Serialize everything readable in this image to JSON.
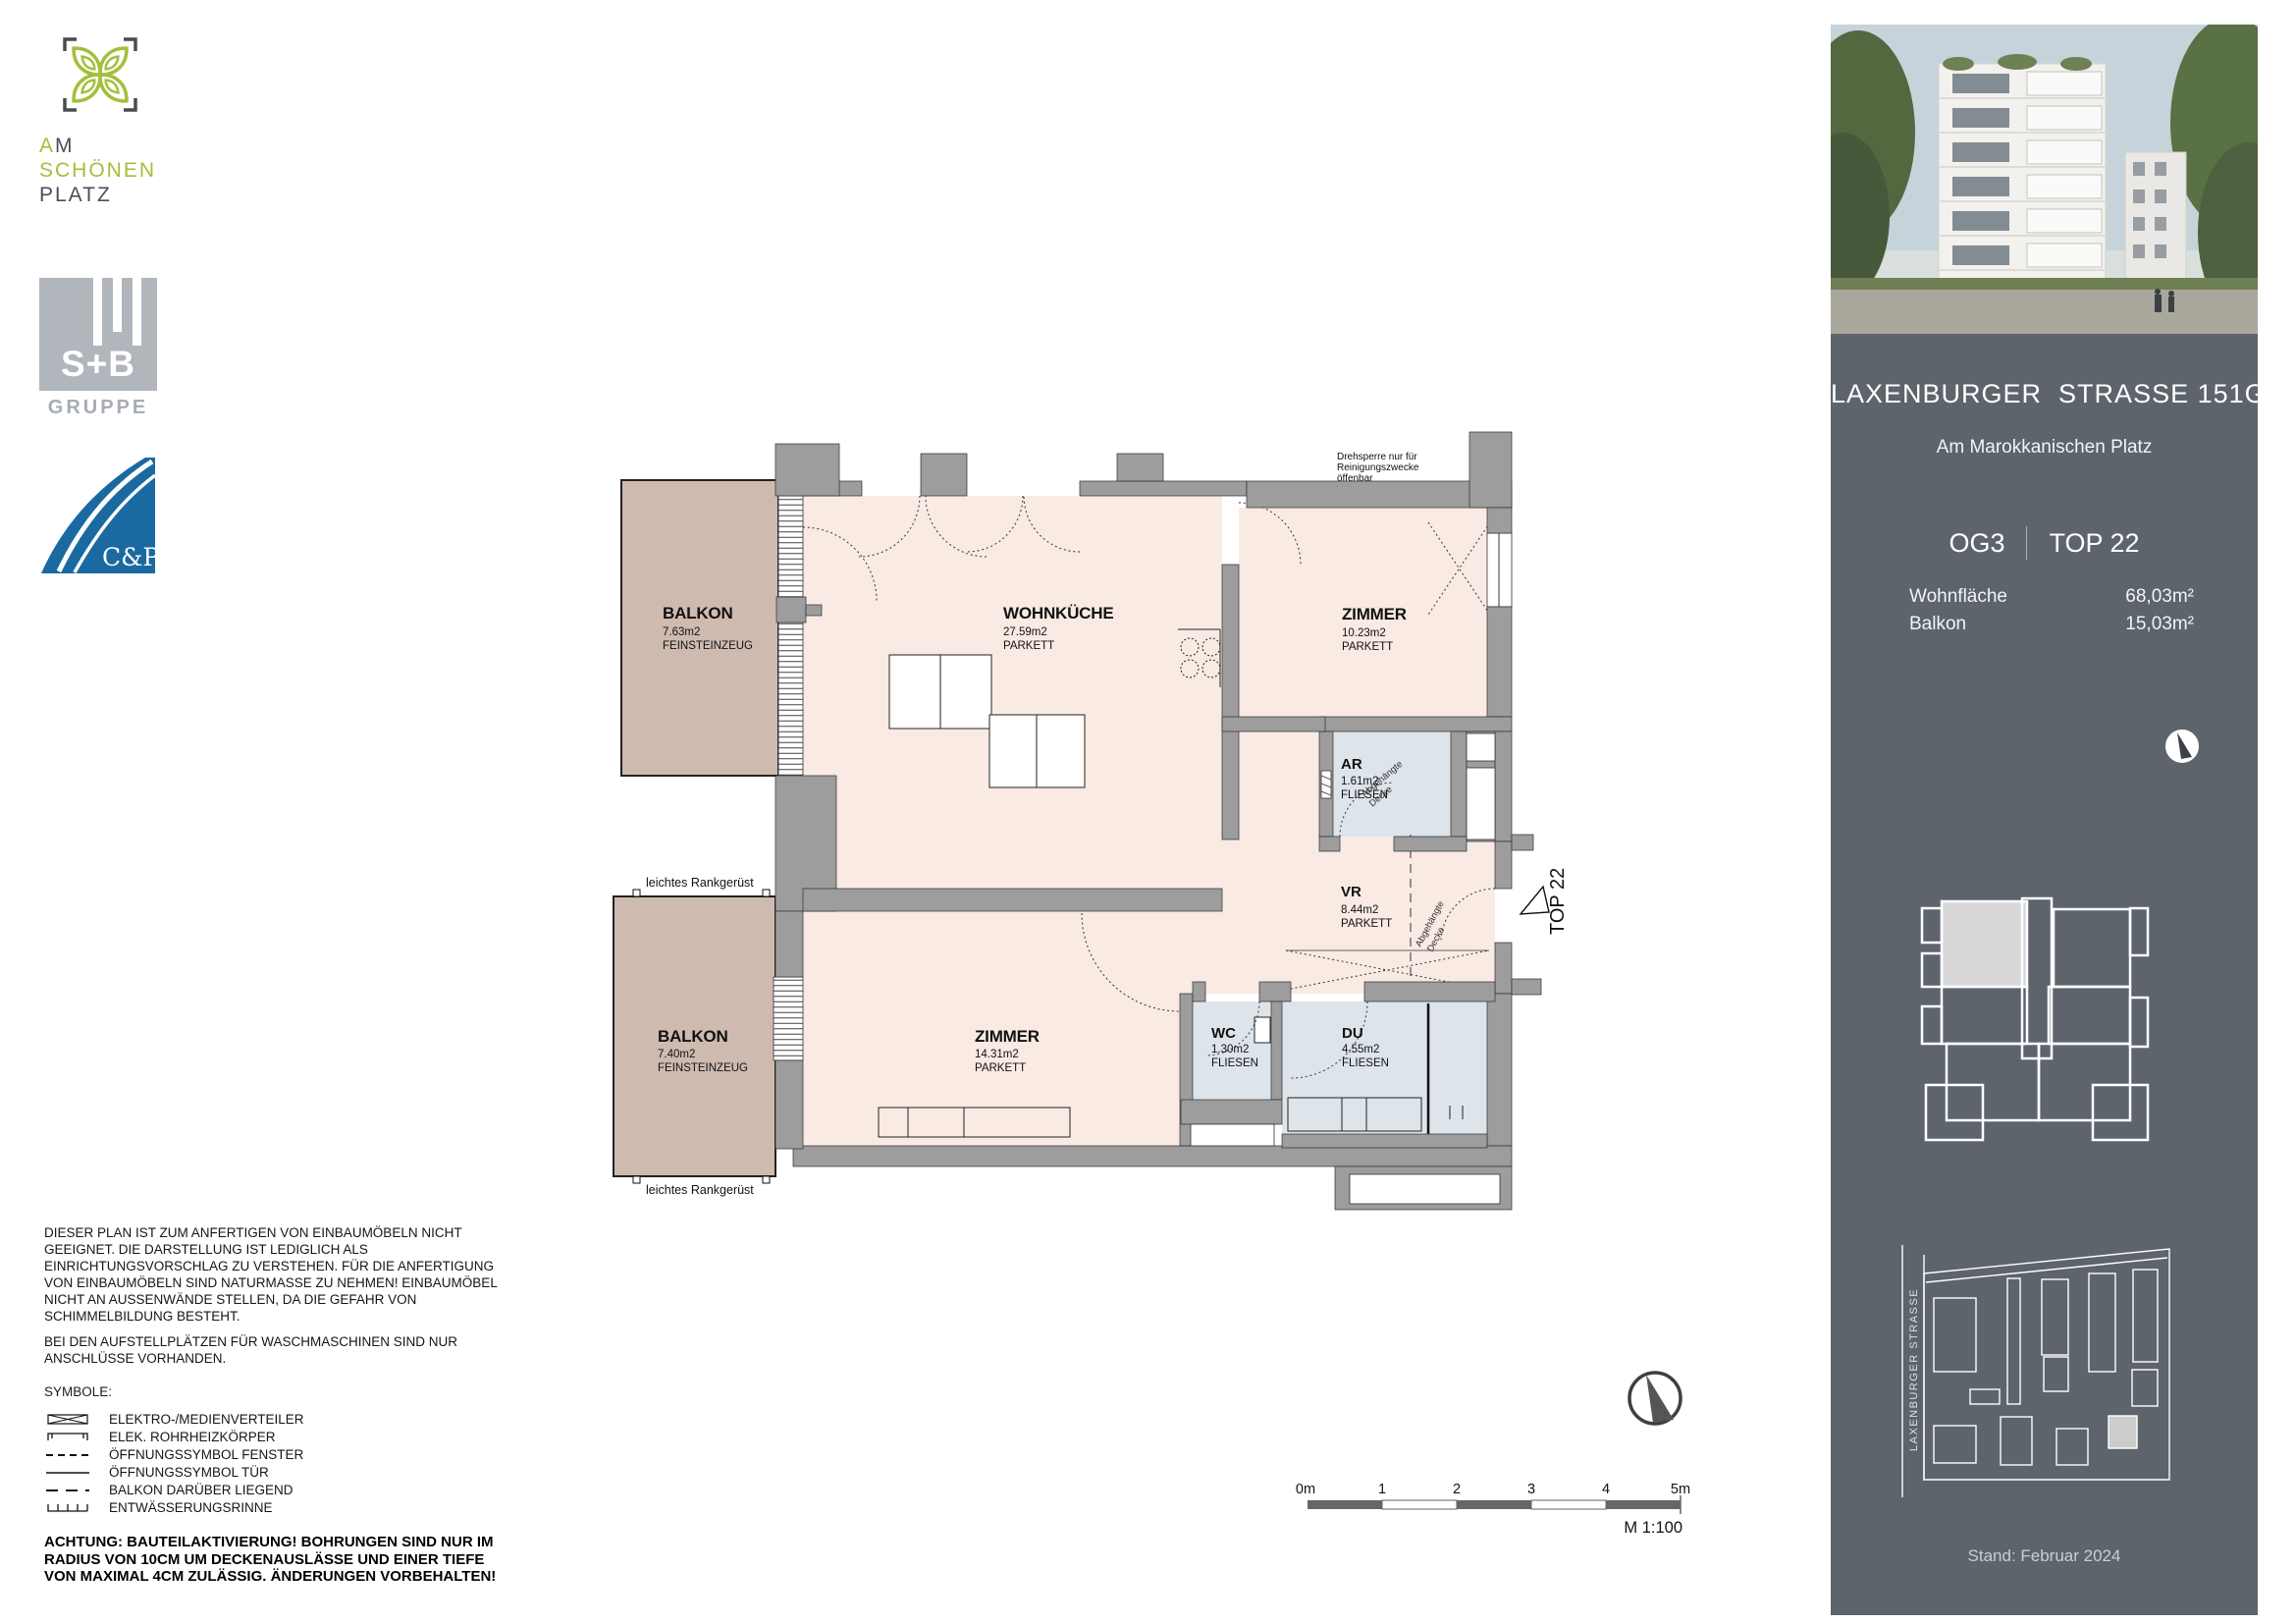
{
  "branding": {
    "asp": {
      "line1": "AM",
      "line2": "SCHÖNEN",
      "line3": "PLATZ"
    },
    "sb": {
      "name": "S+B",
      "sub": "GRUPPE"
    },
    "cp": {
      "name": "C&P"
    }
  },
  "sidebar": {
    "title": "LAXENBURGER  STRASSE 151G",
    "subtitle": "Am Marokkanischen Platz",
    "floor": "OG3",
    "top": "TOP 22",
    "area_rows": [
      {
        "label": "Wohnfläche",
        "value": "68,03m²"
      },
      {
        "label": "Balkon",
        "value": "15,03m²"
      }
    ],
    "street": "LAXENBURGER STRASSE",
    "date": "Stand: Februar 2024"
  },
  "plan": {
    "rooms": [
      {
        "name": "WOHNKÜCHE",
        "area": "27.59m2",
        "floor": "PARKETT"
      },
      {
        "name": "ZIMMER",
        "area": "10.23m2",
        "floor": "PARKETT"
      },
      {
        "name": "AR",
        "area": "1.61m2",
        "floor": "FLIESEN"
      },
      {
        "name": "VR",
        "area": "8.44m2",
        "floor": "PARKETT"
      },
      {
        "name": "WC",
        "area": "1.30m2",
        "floor": "FLIESEN"
      },
      {
        "name": "DU",
        "area": "4.55m2",
        "floor": "FLIESEN"
      },
      {
        "name": "ZIMMER",
        "area": "14.31m2",
        "floor": "PARKETT"
      },
      {
        "name": "BALKON",
        "area": "7.63m2",
        "floor": "FEINSTEINZEUG"
      },
      {
        "name": "BALKON",
        "area": "7.40m2",
        "floor": "FEINSTEINZEUG"
      }
    ],
    "notes": {
      "drehsperre1": "Drehsperre nur für",
      "drehsperre2": "Reinigungszwecke",
      "drehsperre3": "öffenbar",
      "rank": "leichtes Rankgerüst",
      "ceiling1": "Abgehängte",
      "ceiling2": "Decke",
      "top_marker": "TOP 22"
    },
    "scale": {
      "labels": [
        "0m",
        "1",
        "2",
        "3",
        "4",
        "5m"
      ],
      "ratio": "M 1:100"
    }
  },
  "disclaimer": {
    "p1": "DIESER PLAN IST ZUM ANFERTIGEN VON EINBAUMÖBELN NICHT GEEIGNET. DIE DARSTELLUNG IST LEDIGLICH ALS EINRICHTUNGSVORSCHLAG ZU VERSTEHEN. FÜR DIE ANFERTIGUNG VON EINBAUMÖBELN SIND NATURMASSE ZU NEHMEN! EINBAUMÖBEL NICHT AN AUSSENWÄNDE STELLEN, DA DIE GEFAHR VON SCHIMMELBILDUNG BESTEHT.",
    "p2": "BEI DEN AUFSTELLPLÄTZEN FÜR WASCHMASCHINEN SIND NUR ANSCHLÜSSE VORHANDEN.",
    "symbols_heading": "SYMBOLE:"
  },
  "legend": {
    "items": [
      {
        "label": "ELEKTRO-/MEDIENVERTEILER"
      },
      {
        "label": "ELEK. ROHRHEIZKÖRPER"
      },
      {
        "label": "ÖFFNUNGSSYMBOL FENSTER"
      },
      {
        "label": "ÖFFNUNGSSYMBOL TÜR"
      },
      {
        "label": "BALKON DARÜBER LIEGEND"
      },
      {
        "label": "ENTWÄSSERUNGSRINNE"
      }
    ]
  },
  "warning": "ACHTUNG: BAUTEILAKTIVIERUNG! BOHRUNGEN SIND NUR IM RADIUS VON 10CM UM DECKENAUSLÄSSE UND EINER TIEFE VON MAXIMAL 4CM ZULÄSSIG. ÄNDERUNGEN VORBEHALTEN!",
  "colors": {
    "accent_green": "#a3bf3b",
    "logo_blue": "#1a6aa1",
    "sidebar": "#5d646b",
    "balcony": "#cfbab0",
    "room": "#f9eae3",
    "wet": "#dde4ea",
    "wall": "#9d9d9d"
  }
}
